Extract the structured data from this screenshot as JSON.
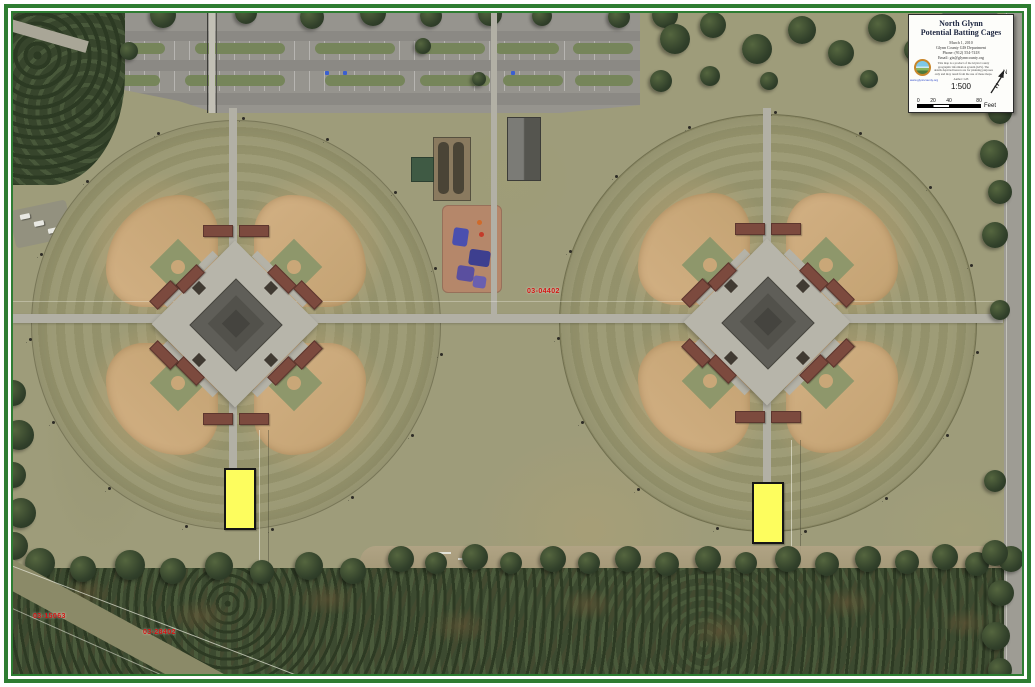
{
  "title_block": {
    "title_line1": "North Glynn",
    "title_line2": "Potential Batting Cages",
    "date": "March 1, 2010",
    "info_lines": [
      "Glynn County GIS Department",
      "Phone: (912) 554-7418",
      "Email: gis@glynncounty.org"
    ],
    "disclaimer": "This map is a product of the Glynn County geographic information system (GIS). The details depicted hereon are for planning purposes only and may result from the use of these maps.",
    "website": "www.glynncounty.org",
    "author": "Author: GIS",
    "scale_ratio": "1:500",
    "scale_ticks": [
      "0",
      "20",
      "40",
      "80"
    ],
    "scale_unit": "Feet",
    "north_label": "N"
  },
  "parcel_labels": [
    {
      "id": "03-04402"
    },
    {
      "id": "03-15063"
    },
    {
      "id": "03-28402"
    }
  ],
  "annotations": {
    "proposed_cage_fill": "#fdfd5e",
    "frame_color": "#2e7d32",
    "parcel_text_color": "#d41414"
  }
}
